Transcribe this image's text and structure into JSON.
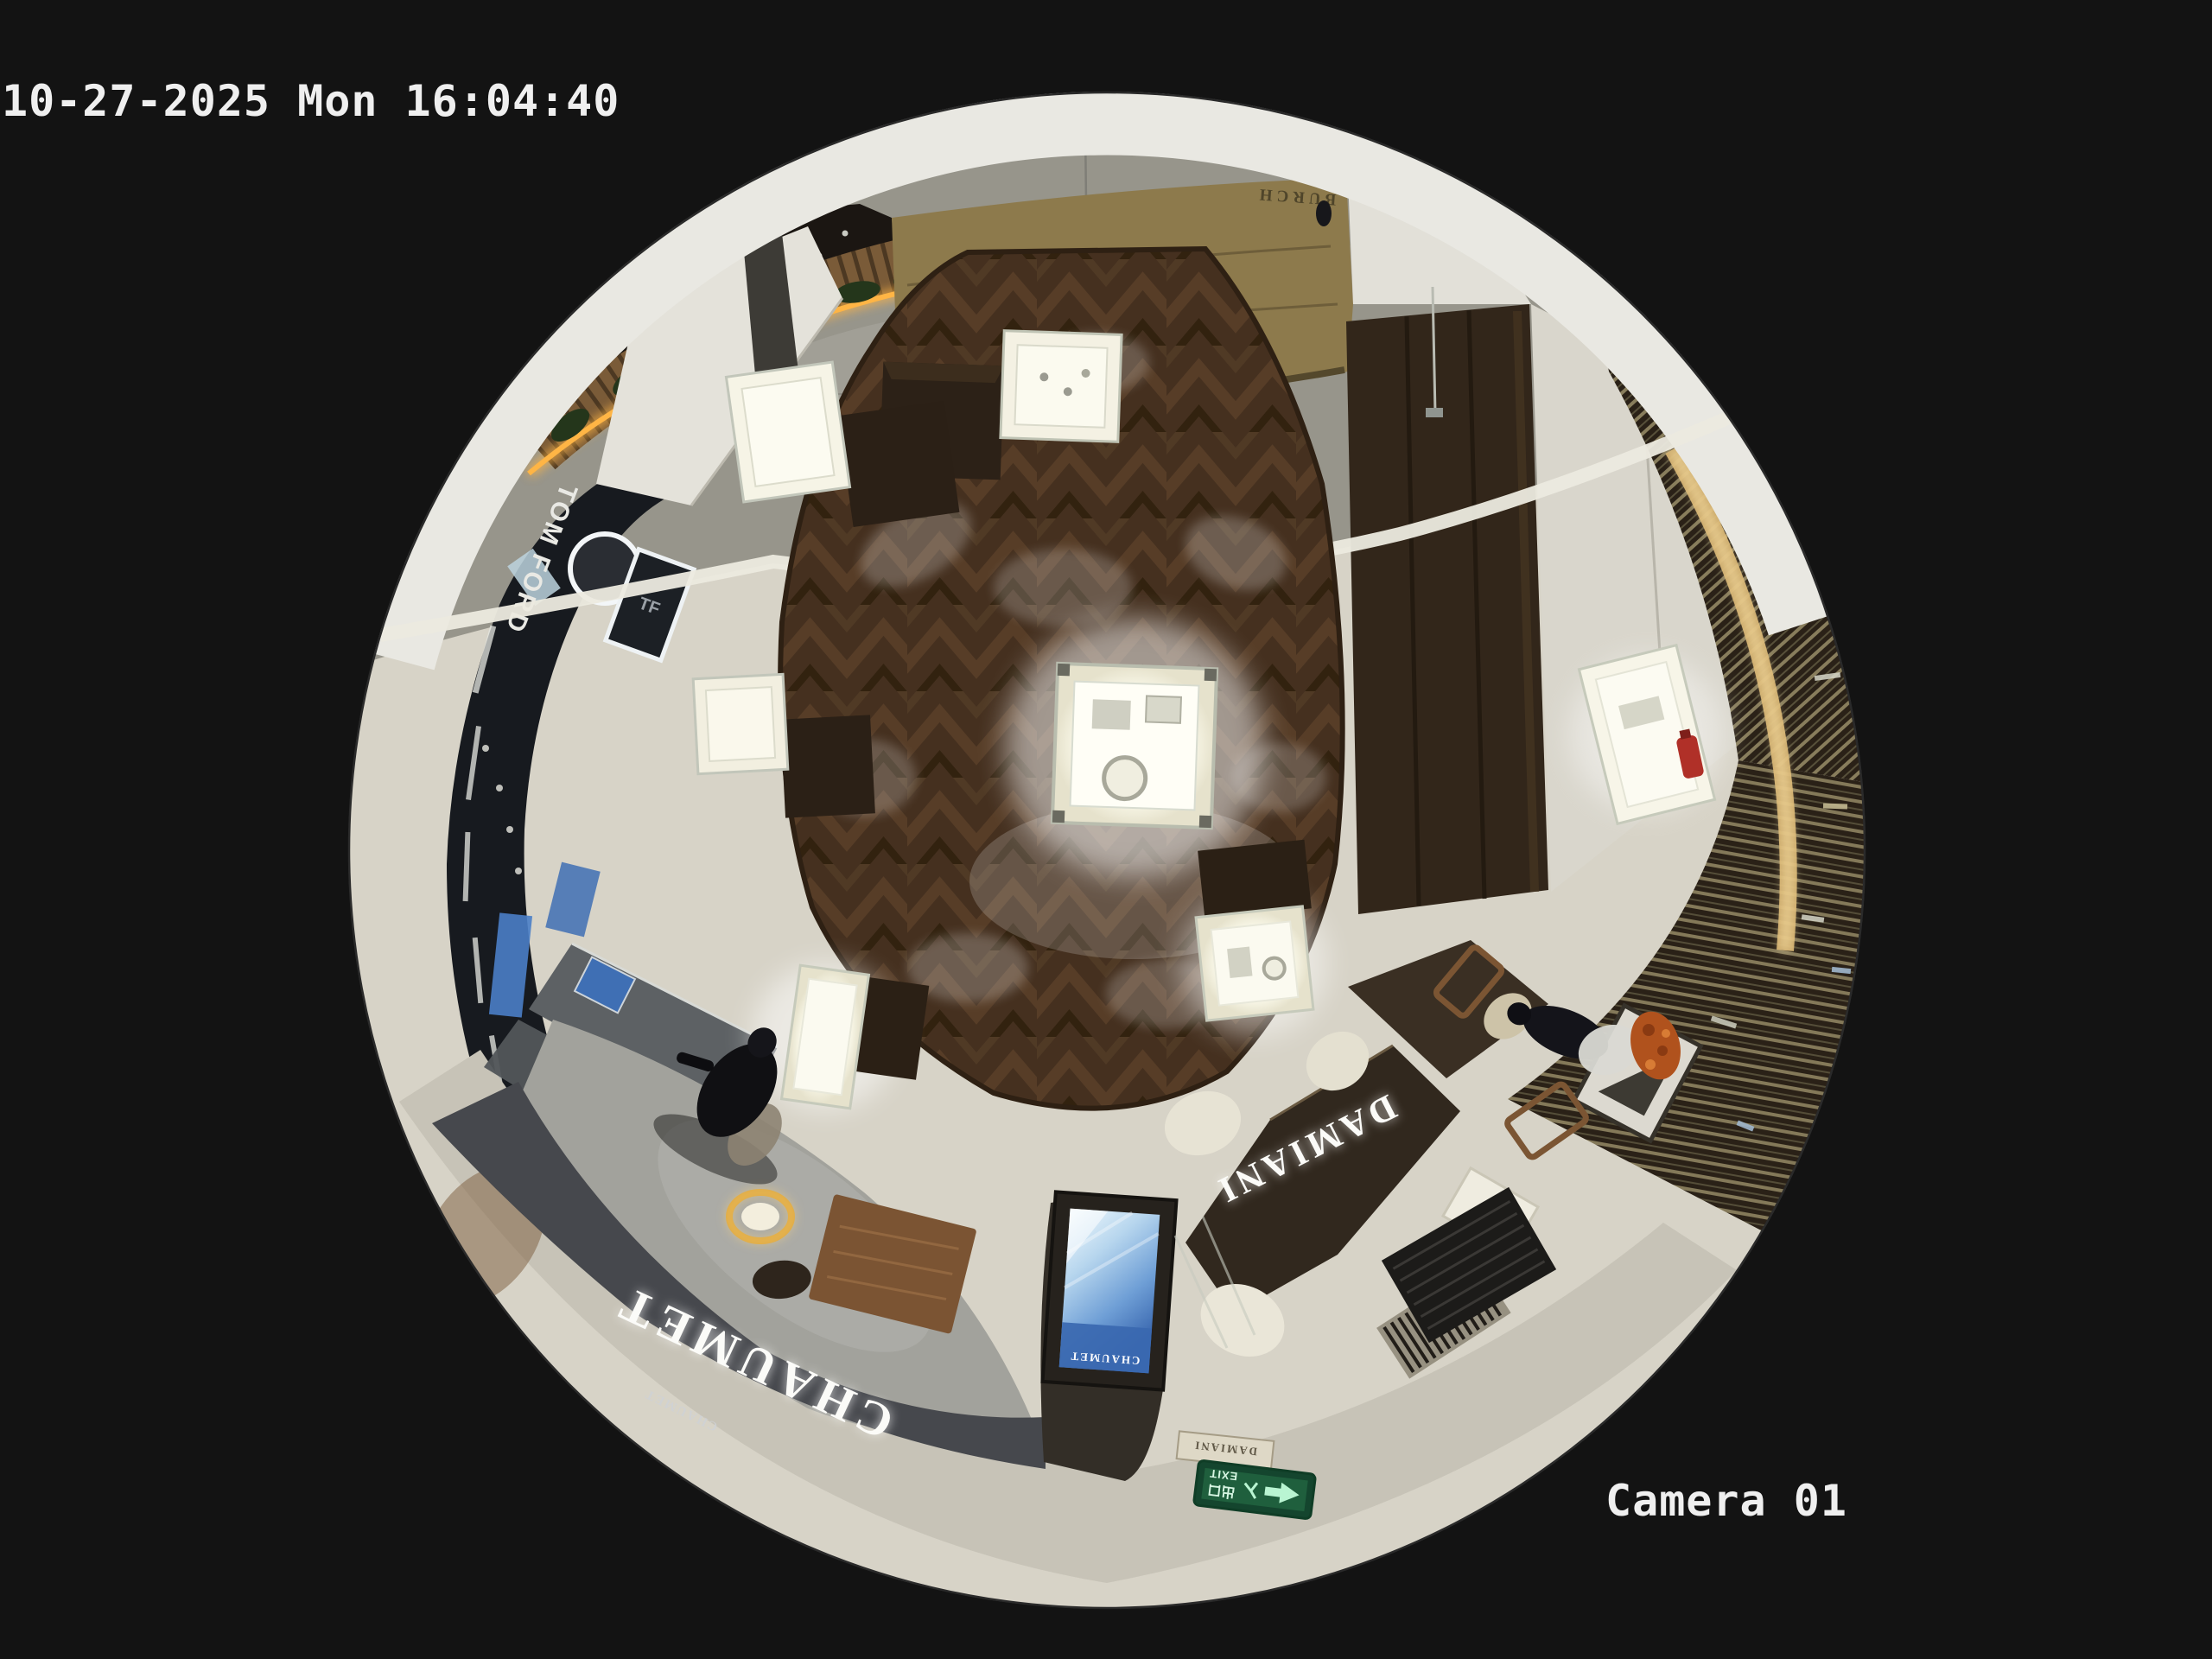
{
  "osd": {
    "timestamp": "10-27-2025 Mon 16:04:40",
    "camera_label": "Camera 01"
  },
  "scene": {
    "signs": {
      "tom_ford": "TOM FORD",
      "chaumet_fascia": "CHAUMET",
      "chaumet_small": "CHAUMET",
      "chaumet_screen": "CHAUMET",
      "damiani_fascia": "DAMIANI",
      "damiani_small": "DAMIANI",
      "gold_wall": "BURCH",
      "exit_cn": "出口",
      "exit_en": "EXIT"
    },
    "colors": {
      "background": "#131313",
      "osd_text": "#efefef",
      "wood_floor": "#45301f",
      "light_floor": "#d7d3c7",
      "marble": "#97958b",
      "carpet": "#a2a29c",
      "fascia_chaumet": "#46484d",
      "fascia_damiani": "#31281e",
      "sign_white": "#fbfbf8",
      "accent_gold": "#ffb545",
      "exit_green": "#14452e",
      "screen_blue": "#3a68b0"
    }
  }
}
